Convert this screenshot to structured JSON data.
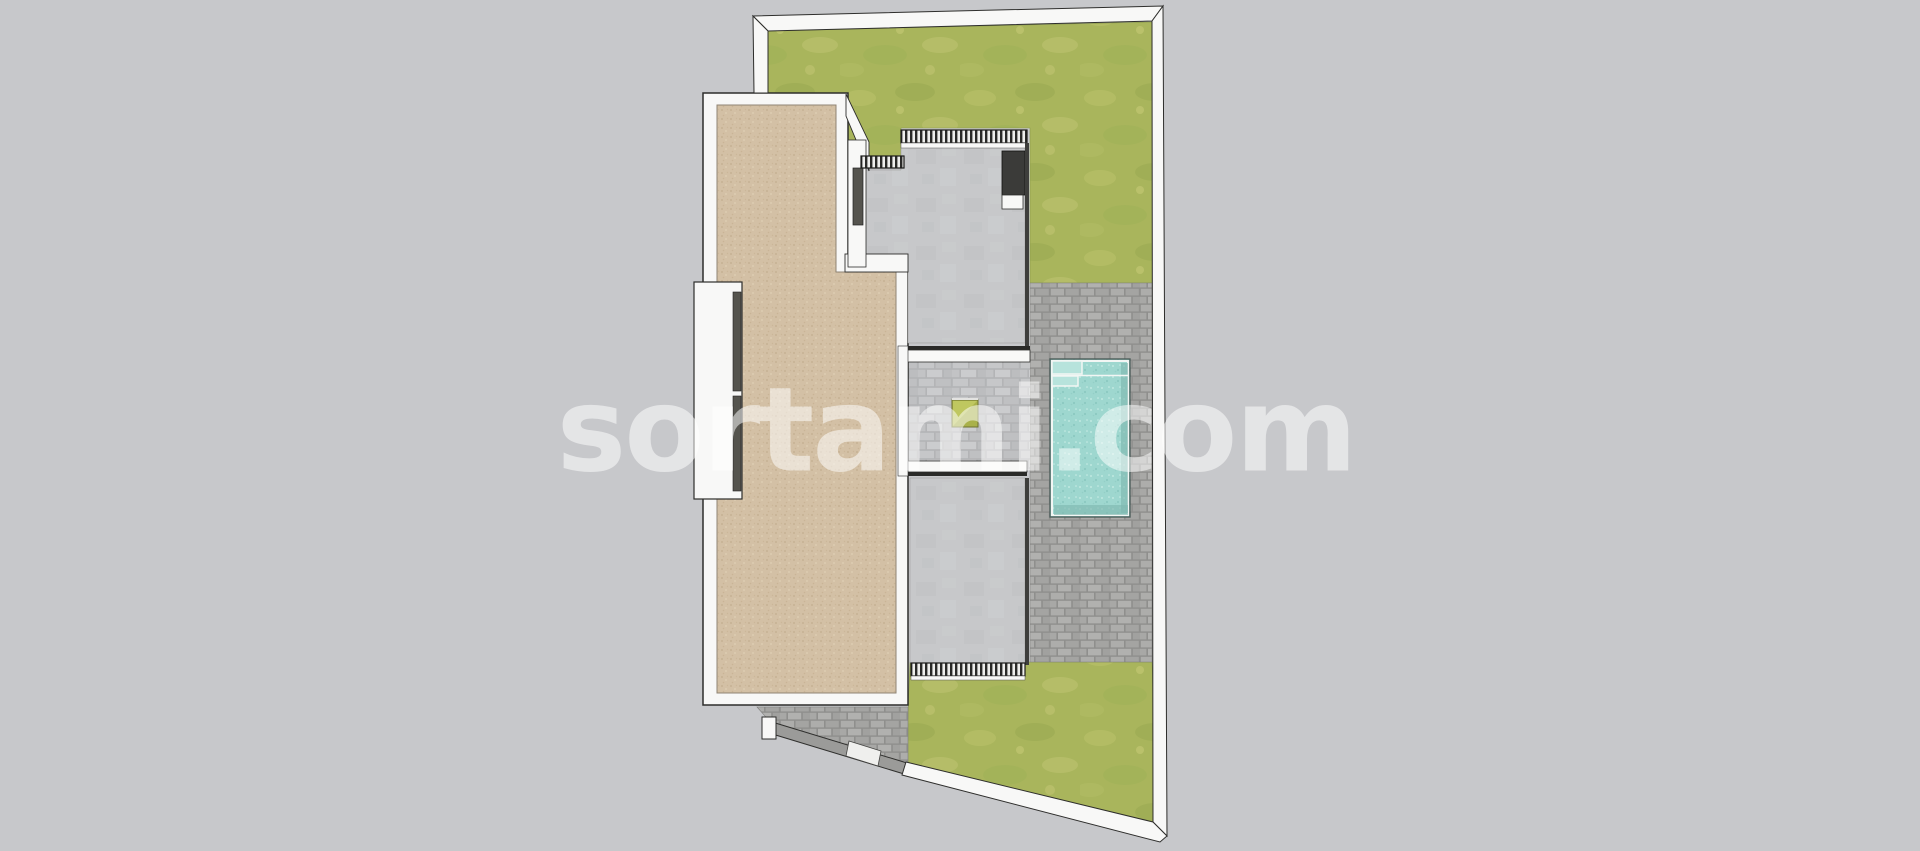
{
  "watermark": {
    "text": "sortami.com"
  },
  "plan": {
    "view": "top-down site plan render",
    "features": {
      "pool": "swimming-pool",
      "lawn_top": "grass-area-north",
      "lawn_bottom": "grass-area-south",
      "roof_terrace": "tan-tiled-roof-terrace",
      "upper_patio": "concrete-patio-north",
      "lower_patio": "concrete-patio-south",
      "courtyard": "central-courtyard",
      "planter": "green-planter-box",
      "driveway": "cobbled-entrance-path",
      "gate": "slanted-entrance-gate",
      "boundary": "white-property-boundary-wall"
    }
  },
  "colors": {
    "background": "#c7c8cb",
    "wall": "#f8f8f7",
    "outline": "#2e2e2c",
    "lawn": "#a9b55c",
    "lawn_light": "#bdc46c",
    "lawn_dark": "#98a850",
    "tan_tile": "#d3c0a5",
    "tan_tile_dark": "#c2ad8e",
    "concrete": "#c7c8ca",
    "cobble": "#8f8f8d",
    "cobble_light": "#aeaeac",
    "courtyard_floor": "#bfc0c2",
    "pool_water": "#9ed7cf",
    "pool_water_light": "#bfe8e1",
    "pool_water_dark": "#7fb9b1",
    "pool_coping": "#f2f6f4",
    "planter_green": "#a9b14a",
    "planter_green_light": "#bfc75f",
    "dark_fixture": "#3b3b39",
    "window_slot": "#55544e",
    "gate_gray": "#9b9b99",
    "railing_dark": "#2a2a28",
    "watermark": "rgba(255,255,255,0.52)"
  }
}
